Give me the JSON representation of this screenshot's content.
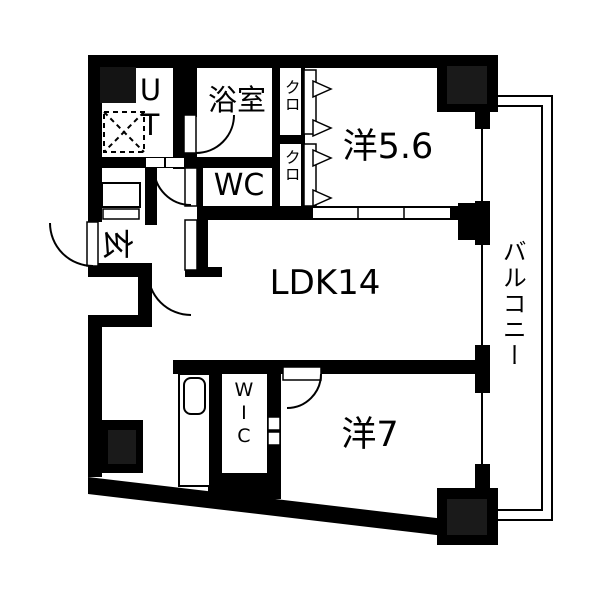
{
  "floorplan": {
    "labels": {
      "ut": "UT",
      "bath": "浴室",
      "closet_upper": "クロ",
      "closet_lower": "クロ",
      "wc": "WC",
      "western_room_56": "洋5.6",
      "entrance": "玄",
      "ldk": "LDK14",
      "wic": "WIC",
      "western_room_7": "洋7",
      "balcony": "バルコニー"
    },
    "colors": {
      "wall": "#000000",
      "floor": "#ffffff",
      "pillar_fill": "#1a1a1a",
      "line": "#000000"
    }
  }
}
